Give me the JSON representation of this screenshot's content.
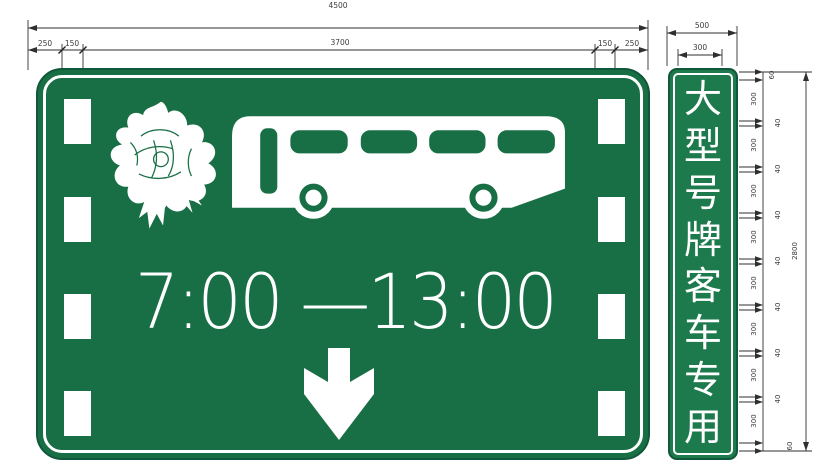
{
  "drawing": {
    "labels": {
      "overall_width": "4500",
      "panel_width": "3700",
      "left_outer_margin": "250",
      "left_inner_margin": "150",
      "right_inner_margin": "150",
      "right_outer_margin": "250",
      "side_board_width": "500",
      "side_char_width": "300",
      "side_board_height": "2800",
      "side_char_height": "300",
      "side_char_gap": "40",
      "side_end_margin": "60"
    },
    "line_color": "#2f2f2f"
  },
  "main_sign": {
    "board_color": "#186f45",
    "border_color": "#ffffff",
    "time_text": "7:00 —13:00",
    "pictograms": [
      "peony-flower",
      "bus",
      "down-arrow"
    ]
  },
  "side_sign": {
    "board_color": "#1d7a4c",
    "text": "大型号牌客车专用",
    "characters": [
      "大",
      "型",
      "号",
      "牌",
      "客",
      "车",
      "专",
      "用"
    ]
  }
}
